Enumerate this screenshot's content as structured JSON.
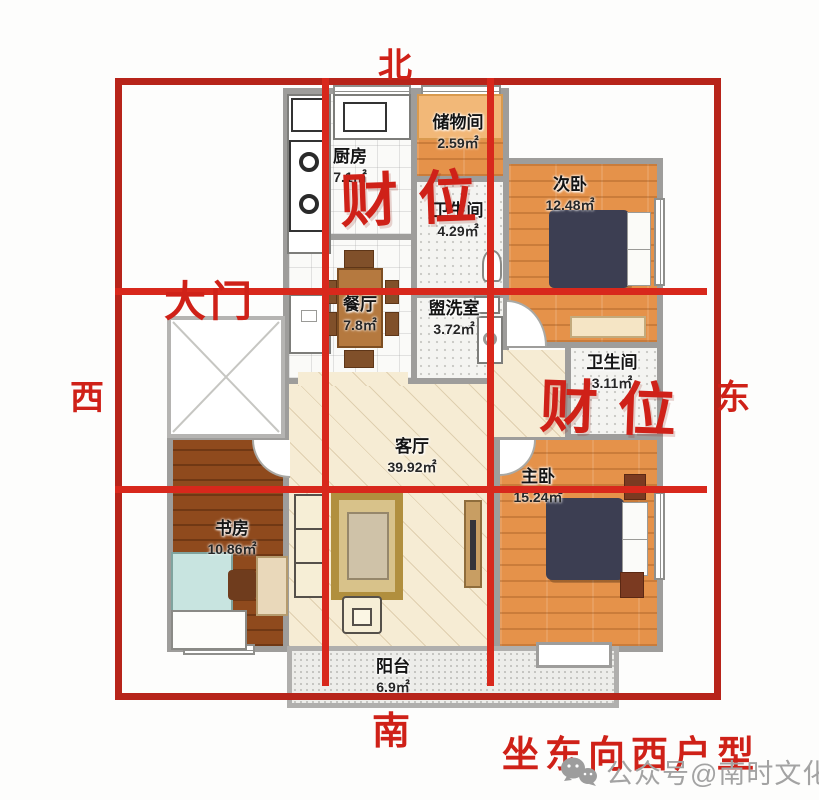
{
  "compass": {
    "north": "北",
    "south": "南",
    "west": "西",
    "east": "东"
  },
  "annotations": {
    "main_door": "大门",
    "wealth_label_1": "财位",
    "wealth_label_2": "财位",
    "footer_title": "坐东向西户型",
    "watermark": "公众号@南时文化"
  },
  "rooms": [
    {
      "id": "kitchen",
      "name": "厨房",
      "area": "7.1㎡"
    },
    {
      "id": "storage",
      "name": "储物间",
      "area": "2.59㎡"
    },
    {
      "id": "bath1",
      "name": "卫生间",
      "area": "4.29㎡"
    },
    {
      "id": "bedroom2",
      "name": "次卧",
      "area": "12.48㎡"
    },
    {
      "id": "dining",
      "name": "餐厅",
      "area": "7.8㎡"
    },
    {
      "id": "washroom",
      "name": "盥洗室",
      "area": "3.72㎡"
    },
    {
      "id": "bath2",
      "name": "卫生间",
      "area": "3.11㎡"
    },
    {
      "id": "living",
      "name": "客厅",
      "area": "39.92㎡"
    },
    {
      "id": "master",
      "name": "主卧",
      "area": "15.24㎡"
    },
    {
      "id": "study",
      "name": "书房",
      "area": "10.86㎡"
    },
    {
      "id": "balcony",
      "name": "阳台",
      "area": "6.9㎡"
    }
  ],
  "colors": {
    "annotation_red": "#cf2118",
    "grid_red": "#d8281c",
    "grid_frame_red": "#b7241a",
    "wall_gray": "#9e9d9b",
    "wood_orange": "#e5924a",
    "study_brown": "#8f4a1d",
    "living_cream": "#f6ecd4",
    "bed_navy": "#3c3e52",
    "watermark_gray": "#a3a3a3"
  }
}
